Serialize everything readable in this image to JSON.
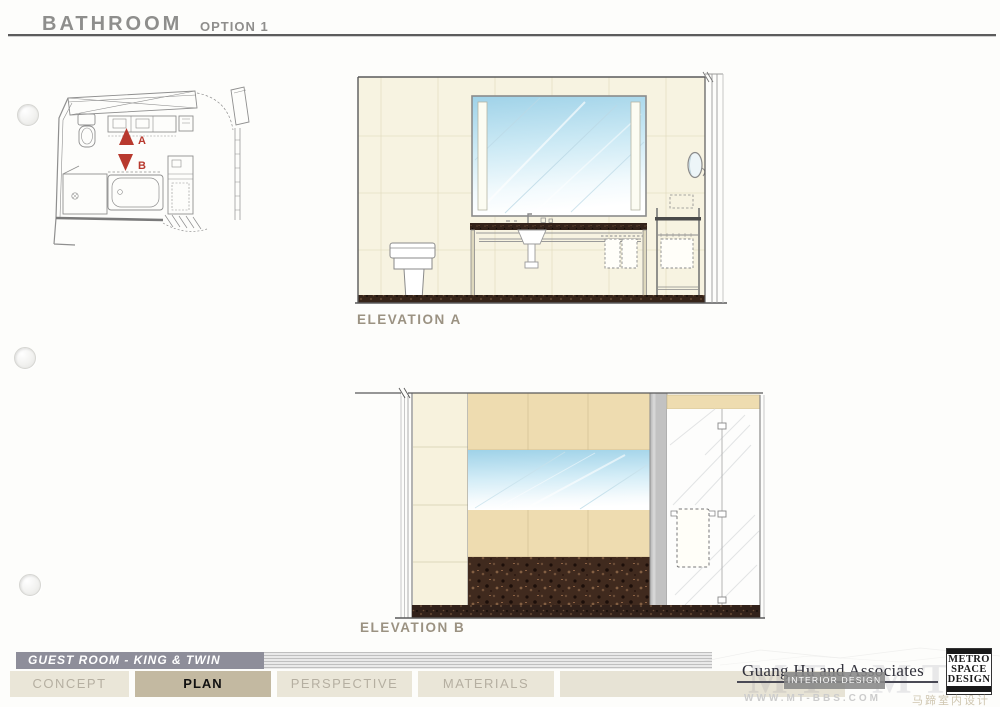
{
  "header": {
    "title": "BATHROOM",
    "option": "OPTION 1"
  },
  "plan": {
    "markers": [
      "A",
      "B"
    ]
  },
  "elevations": {
    "a": {
      "label": "ELEVATION A"
    },
    "b": {
      "label": "ELEVATION B"
    }
  },
  "footer": {
    "section_title": "GUEST ROOM - KING & TWIN",
    "tabs": [
      {
        "label": "CONCEPT",
        "active": false
      },
      {
        "label": "PLAN",
        "active": true
      },
      {
        "label": "PERSPECTIVE",
        "active": false
      },
      {
        "label": "MATERIALS",
        "active": false
      }
    ]
  },
  "brand": {
    "company": "Guang Hu and Associates",
    "tagline": "INTERIOR DESIGN",
    "logo": [
      "METRO",
      "SPACE",
      "DESIGN"
    ]
  },
  "watermark": {
    "site": "WWW.MT-BBS.COM",
    "cn": "马蹄室内设计网",
    "ghost": "MT"
  },
  "colors": {
    "marker_red": "#b8392e",
    "wall_cream": "#f7f3e1",
    "tile_tan": "#eedcb0",
    "mosaic_brown": "#402a1e",
    "mirror_blue": "#9fd2e8",
    "tab_active_bg": "#c3b9a1",
    "tab_inactive_bg": "#eae6d8",
    "footer_bar_bg": "#8e8e9a"
  }
}
